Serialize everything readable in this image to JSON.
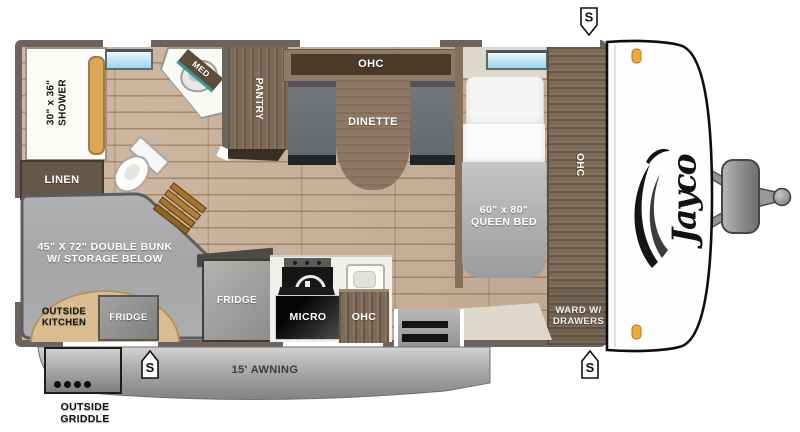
{
  "floorplan": {
    "brand": "Jayco",
    "speaker": "S",
    "exterior": {
      "awning": "15' AWNING",
      "griddle": "OUTSIDE\nGRIDDLE"
    },
    "bathroom": {
      "shower": "30\" x 36\"\nSHOWER",
      "med": "MED",
      "linen": "LINEN"
    },
    "galley": {
      "pantry": "PANTRY",
      "fridge": "FRIDGE",
      "micro": "MICRO",
      "ohc": "OHC"
    },
    "dinette": {
      "ohc": "OHC",
      "table": "DINETTE"
    },
    "bedroom": {
      "bed": "60\" x 80\"\nQUEEN BED",
      "ohc": "OHC",
      "ward": "WARD W/\nDRAWERS"
    },
    "bunk": {
      "label": "45\" X 72\" DOUBLE BUNK\nW/ STORAGE BELOW",
      "outside_kitchen": "OUTSIDE\nKITCHEN",
      "fridge": "FRIDGE"
    },
    "colors": {
      "wall": "#6b635c",
      "floor_wood": "#c9b199",
      "cabinet_wood": "#7d6b58",
      "awning_gray": "#a9a9ab",
      "marker_light_orange": "#f2a73c",
      "med_accent_teal": "#2f9e9a"
    }
  }
}
